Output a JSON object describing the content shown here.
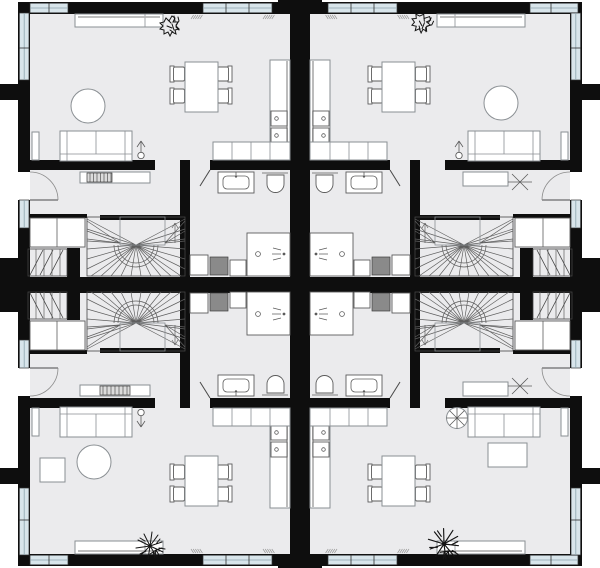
{
  "scene": {
    "type": "architectural-floor-plan",
    "description": "Floor plan of four mirrored dwelling units in a 2x2 arrangement separated by thick party walls, each unit with open living-dining-kitchen, entrance hall, bathroom and winder staircase",
    "units": [
      {
        "id": "top-left",
        "entry": "left-wall-door",
        "hall_items": [
          "console",
          "radiator"
        ],
        "bathroom_items": [
          "washbasin",
          "toilet",
          "shower",
          "washing-machine",
          "cabinet",
          "cabinet"
        ],
        "stair_items": [
          "winder-staircase",
          "basement-stair",
          "closet"
        ],
        "living_items": [
          "sofa",
          "side-table",
          "round-coffee-table",
          "floor-lamp",
          "dining-table",
          "four-chairs",
          "sideboard",
          "potted-plant",
          "kitchen-tall-counter",
          "cooktop-two-burners",
          "kitchen-base-cabinets"
        ]
      },
      {
        "id": "top-right",
        "entry": "right-wall-door",
        "hall_items": [
          "bench",
          "coat-rack"
        ],
        "bathroom_items": [
          "washbasin",
          "toilet",
          "shower",
          "washing-machine",
          "cabinet",
          "cabinet"
        ],
        "stair_items": [
          "winder-staircase",
          "basement-stair",
          "closet"
        ],
        "living_items": [
          "sofa",
          "side-table",
          "round-coffee-table",
          "floor-lamp",
          "dining-table",
          "four-chairs",
          "sideboard",
          "potted-plant",
          "kitchen-tall-counter",
          "cooktop-two-burners",
          "kitchen-base-cabinets"
        ]
      },
      {
        "id": "bottom-left",
        "entry": "left-wall-door",
        "hall_items": [
          "console",
          "radiator"
        ],
        "bathroom_items": [
          "washbasin",
          "toilet",
          "shower",
          "washing-machine",
          "cabinet",
          "cabinet"
        ],
        "stair_items": [
          "winder-staircase",
          "basement-stair",
          "closet"
        ],
        "living_items": [
          "sofa",
          "side-table",
          "round-coffee-table",
          "square-side-table",
          "floor-lamp",
          "dining-table",
          "four-chairs",
          "sideboard",
          "potted-plant",
          "kitchen-tall-counter",
          "cooktop-two-burners",
          "kitchen-base-cabinets"
        ]
      },
      {
        "id": "bottom-right",
        "entry": "right-wall-door",
        "hall_items": [
          "bench",
          "coat-rack"
        ],
        "bathroom_items": [
          "washbasin",
          "toilet",
          "shower",
          "washing-machine",
          "cabinet",
          "cabinet"
        ],
        "stair_items": [
          "winder-staircase",
          "basement-stair",
          "closet"
        ],
        "living_items": [
          "sofa",
          "side-table",
          "rectangular-coffee-table",
          "round-pedestal-table",
          "floor-lamp",
          "dining-table",
          "four-chairs",
          "sideboard",
          "potted-plant",
          "kitchen-tall-counter",
          "cooktop-two-burners",
          "kitchen-base-cabinets"
        ]
      }
    ]
  },
  "colors": {
    "background": "#ffffff",
    "floor": "#ebebed",
    "wall": "#0e0e0e",
    "window_glass": "#d8e5eb",
    "furniture_stroke": "#8a8f93",
    "fixture_stroke": "#5c5c5c",
    "appliance_fill": "#8a8a8a",
    "stair_line": "#5f5f5f",
    "radiator_fill": "#dcdcdc",
    "sideboard_accent": "#b5b5b5"
  }
}
